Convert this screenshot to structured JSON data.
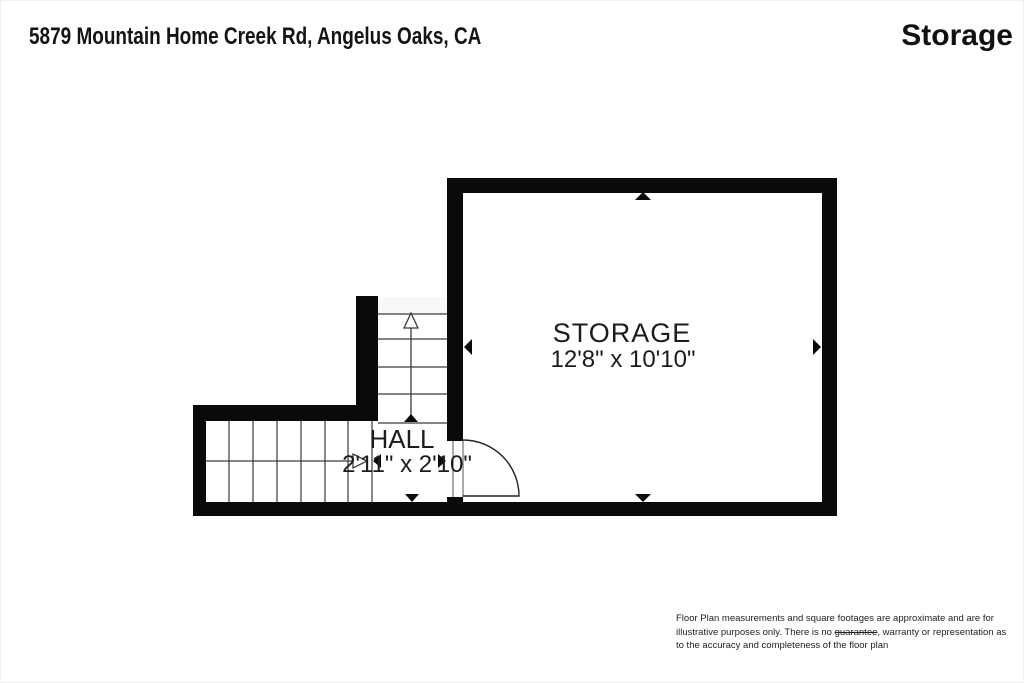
{
  "header": {
    "address": "5879 Mountain Home Creek Rd, Angelus Oaks, CA",
    "floor_title": "Storage"
  },
  "rooms": [
    {
      "name": "STORAGE",
      "dimensions": "12'8\" x 10'10\""
    },
    {
      "name": "HALL",
      "dimensions": "2'11\" x 2'10\""
    }
  ],
  "features": {
    "stairs": "two stair runs with direction arrows leading up from hall",
    "door": "door swinging from hall into storage room"
  },
  "disclaimer": {
    "part1": "Floor Plan measurements and square footages are approximate and are for illustrative purposes only. There is no ",
    "struck": "guarantee",
    "part2": ", warranty or representation as to the accuracy and completeness of the floor plan"
  },
  "colors": {
    "wall": "#0a0a0a",
    "line": "#3a3a3a",
    "background": "#ffffff"
  }
}
